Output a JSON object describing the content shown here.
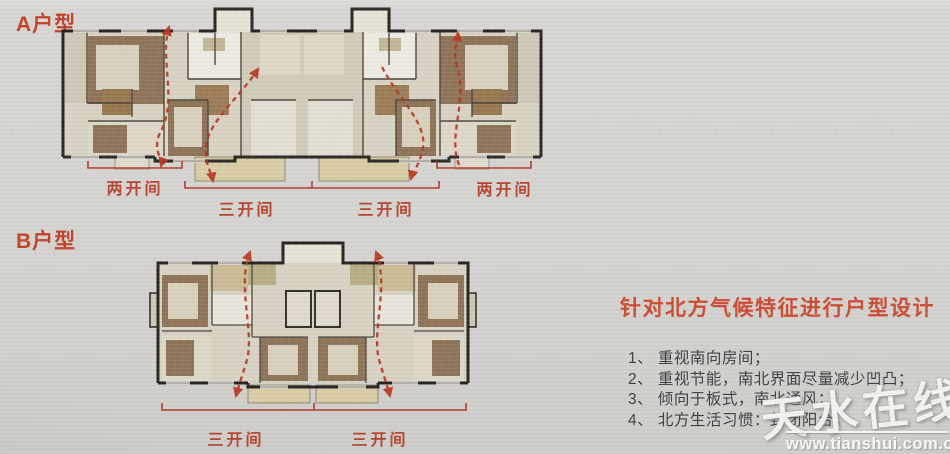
{
  "titles": {
    "plan_a": "A户型",
    "plan_b": "B户型"
  },
  "plan_a": {
    "bay_labels": [
      "两开间",
      "三开间",
      "三开间",
      "两开间"
    ]
  },
  "plan_b": {
    "bay_labels": [
      "三开间",
      "三开间"
    ]
  },
  "right_panel": {
    "heading": "针对北方气候特征进行户型设计",
    "items": [
      "1、 重视南向房间；",
      "2、 重视节能，南北界面尽量减少凹凸；",
      "3、 倾向于板式，南北通风；",
      "4、 北方生活习惯：封闭阳台。"
    ]
  },
  "watermark": {
    "brand": "天水在线",
    "url": "www.tianshui.com.cn"
  },
  "colors": {
    "accent_red": "#c23f26",
    "arrow_red": "#b8341c",
    "wall_dark": "#27241f",
    "room_brown": "#8d7358",
    "floor_tan": "#d8d2c3",
    "balcony_tan": "#d7cca5"
  }
}
